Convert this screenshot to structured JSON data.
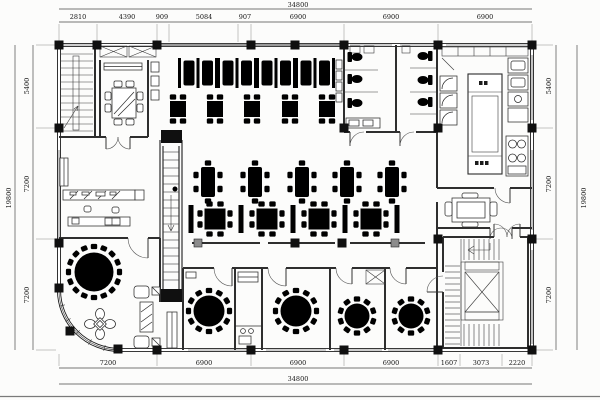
{
  "plan": {
    "type": "architectural floor plan",
    "subject": "restaurant dining level",
    "units": "mm"
  },
  "dimensions": {
    "top": {
      "total": "34800",
      "segments": [
        "2810",
        "4390",
        "909",
        "5084",
        "907",
        "6900",
        "6900",
        "6900"
      ]
    },
    "bottom": {
      "total": "34800",
      "segments": [
        "7200",
        "6900",
        "6900",
        "6900",
        "1607",
        "3073",
        "2220"
      ]
    },
    "left": {
      "total": "19800",
      "segments": [
        "5400",
        "7200",
        "7200"
      ]
    },
    "right": {
      "total": "19800",
      "segments": [
        "5400",
        "7200",
        "7200"
      ]
    }
  },
  "colors": {
    "ink": "#1c1c1c",
    "wall_gray": "#9a9a9a",
    "paper": "#fcfcfb"
  }
}
